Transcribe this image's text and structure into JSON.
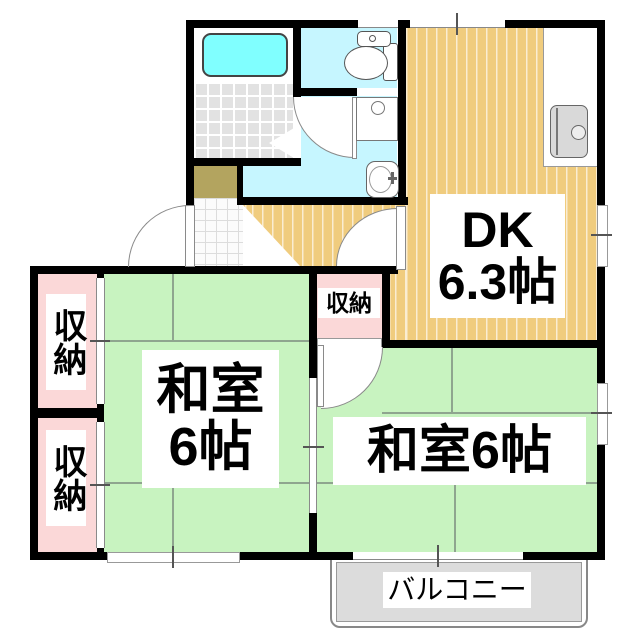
{
  "rooms": {
    "dk": {
      "line1": "DK",
      "line2": "6.3帖"
    },
    "washitsu_left": {
      "line1": "和室",
      "line2": "6帖"
    },
    "washitsu_right": {
      "label": "和室6帖"
    },
    "balcony": {
      "label": "バルコニー"
    }
  },
  "closets": {
    "left_top": {
      "label": "収納"
    },
    "left_bottom": {
      "label": "収納"
    },
    "middle": {
      "label": "収納"
    }
  },
  "colors": {
    "wall": "#000000",
    "tatami_green": "#C8F3C0",
    "wood_orange": "#F0CC7E",
    "closet_pink": "#FBD8D8",
    "water_cyan": "#C6F6FF",
    "bathtub_cyan": "#80FFFF",
    "genkan_khaki": "#B3A45F",
    "balcony_gray": "#DCDCDC"
  }
}
